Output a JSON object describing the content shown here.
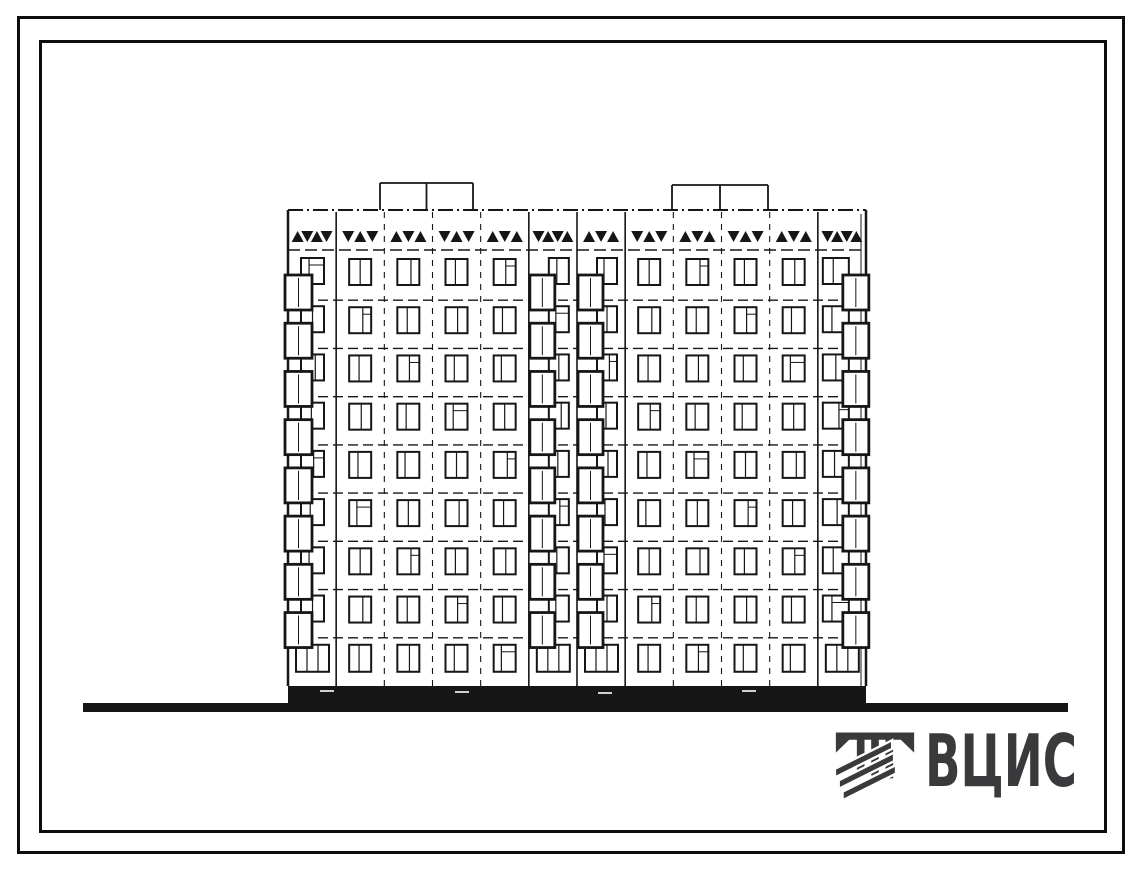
{
  "page": {
    "background": "#ffffff",
    "ink_color": "#161616",
    "logo_color": "#3a3a3c"
  },
  "drawing": {
    "title": "Facade elevation of a 9-storey large-panel residential building",
    "floors": 9,
    "bays": 12,
    "balcony_bays": [
      0,
      5,
      6,
      11
    ],
    "facade": {
      "left": 288,
      "right": 866,
      "parapet_y": 210,
      "frieze_line_y": 250,
      "floors_top": 252,
      "plinth_top": 686,
      "plinth_bottom": 704
    },
    "roof_boxes": [
      {
        "x1": 380,
        "x2": 473,
        "top": 183
      },
      {
        "x1": 672,
        "x2": 768,
        "top": 185
      }
    ],
    "frieze_triangles_per_bay": [
      4,
      3,
      3,
      3,
      3,
      4,
      3,
      3,
      3,
      3,
      3,
      4
    ],
    "ground_line": {
      "x1": 83,
      "x2": 1068,
      "y": 703,
      "thickness": 9
    }
  },
  "logo": {
    "text": "ВЦИС",
    "icon": "vcis-monogram-icon"
  }
}
